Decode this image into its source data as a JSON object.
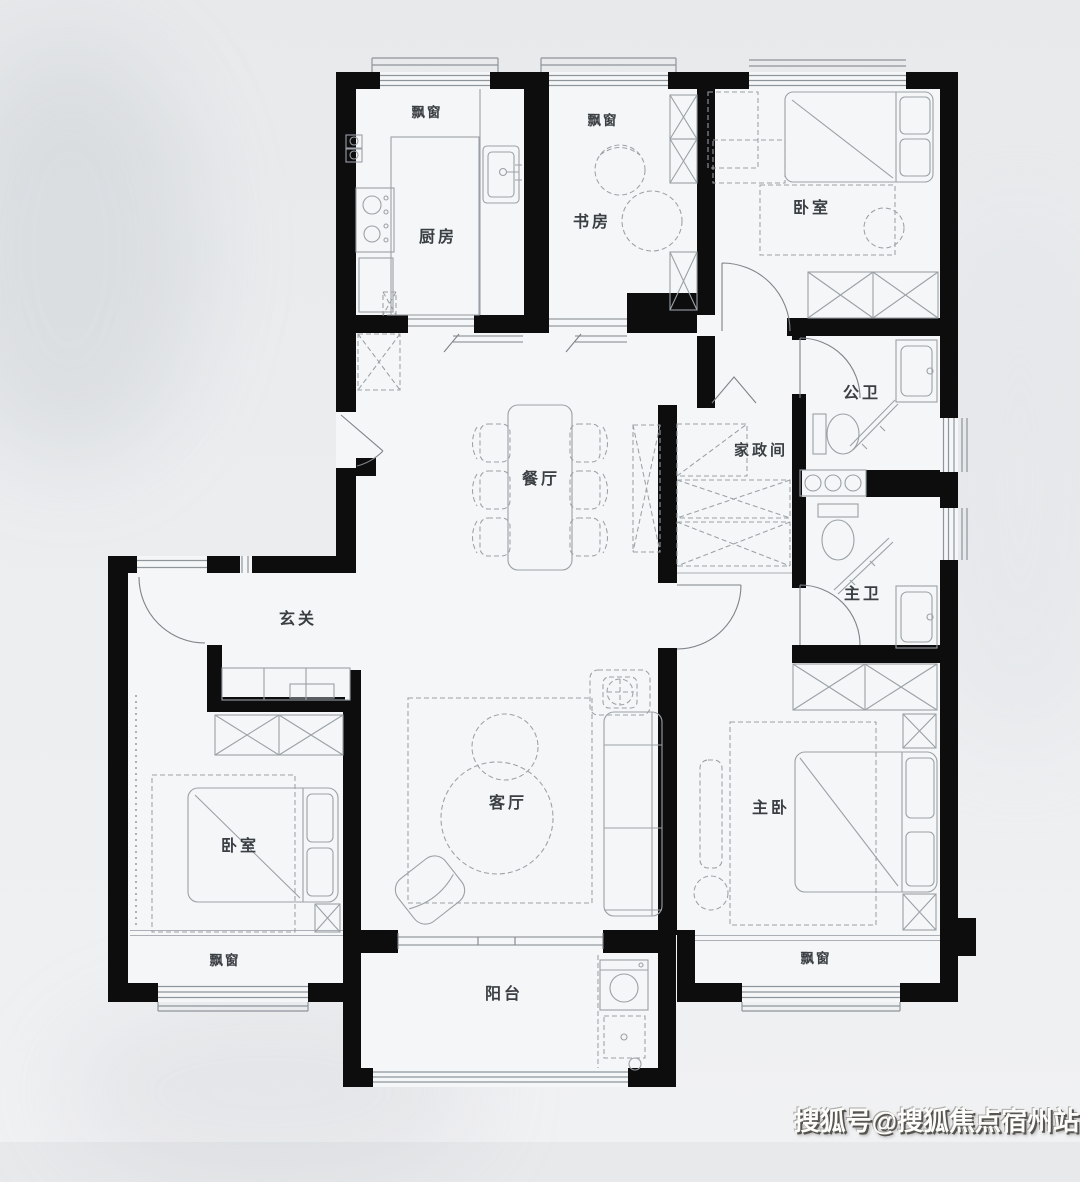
{
  "scene": {
    "colors": {
      "bg-top": "#e7e9eb",
      "bg-bottom": "#f0f1f3",
      "paper": "#f5f6f7",
      "wall": "#0d0d0e",
      "line": "#8e959b",
      "furniture": "#9aa1a7",
      "label": "#3a3f44",
      "watermark-fill": "#fcfcfa",
      "watermark-shadow": "#56544f"
    }
  },
  "floorplan": {
    "rooms": [
      {
        "id": "kitchen",
        "label": "厨房"
      },
      {
        "id": "study",
        "label": "书房"
      },
      {
        "id": "bedroom-top",
        "label": "卧室"
      },
      {
        "id": "public-bath",
        "label": "公卫"
      },
      {
        "id": "utility",
        "label": "家政间"
      },
      {
        "id": "master-bath",
        "label": "主卫"
      },
      {
        "id": "dining",
        "label": "餐厅"
      },
      {
        "id": "foyer",
        "label": "玄关"
      },
      {
        "id": "bedroom-left",
        "label": "卧室"
      },
      {
        "id": "living",
        "label": "客厅"
      },
      {
        "id": "master-bedroom",
        "label": "主卧"
      },
      {
        "id": "balcony",
        "label": "阳台"
      }
    ],
    "bay_windows": [
      {
        "id": "bay-kitchen",
        "label": "飘窗"
      },
      {
        "id": "bay-study",
        "label": "飘窗"
      },
      {
        "id": "bay-bedroom-left",
        "label": "飘窗"
      },
      {
        "id": "bay-master",
        "label": "飘窗"
      }
    ]
  },
  "watermark": {
    "text": "搜狐号@搜狐焦点宿州站"
  }
}
